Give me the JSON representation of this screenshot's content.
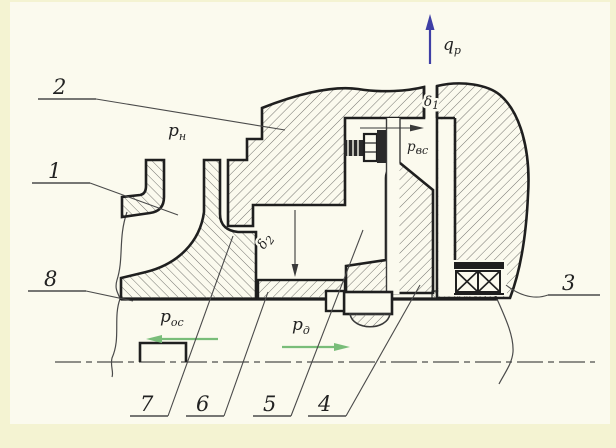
{
  "drawing": {
    "background": "#f4f3d2",
    "panel": "#fbfaee",
    "ink": "#1f1f1f",
    "thin_line": "#4a4a4a",
    "accent_green": "#79bd79",
    "accent_blue": "#3f3fa6",
    "parts": [
      "1",
      "2",
      "3",
      "4",
      "5",
      "6",
      "7",
      "8"
    ],
    "annotations": {
      "p_n": {
        "base": "p",
        "sub": "н"
      },
      "q_p": {
        "base": "q",
        "sub": "р"
      },
      "delta_1": {
        "base": "δ",
        "sub": "1"
      },
      "p_vs": {
        "base": "p",
        "sub": "вс"
      },
      "delta_2": {
        "base": "δ",
        "sub": "2"
      },
      "p_os": {
        "base": "p",
        "sub": "ос"
      },
      "p_d": {
        "base": "p",
        "sub": "д"
      }
    }
  }
}
